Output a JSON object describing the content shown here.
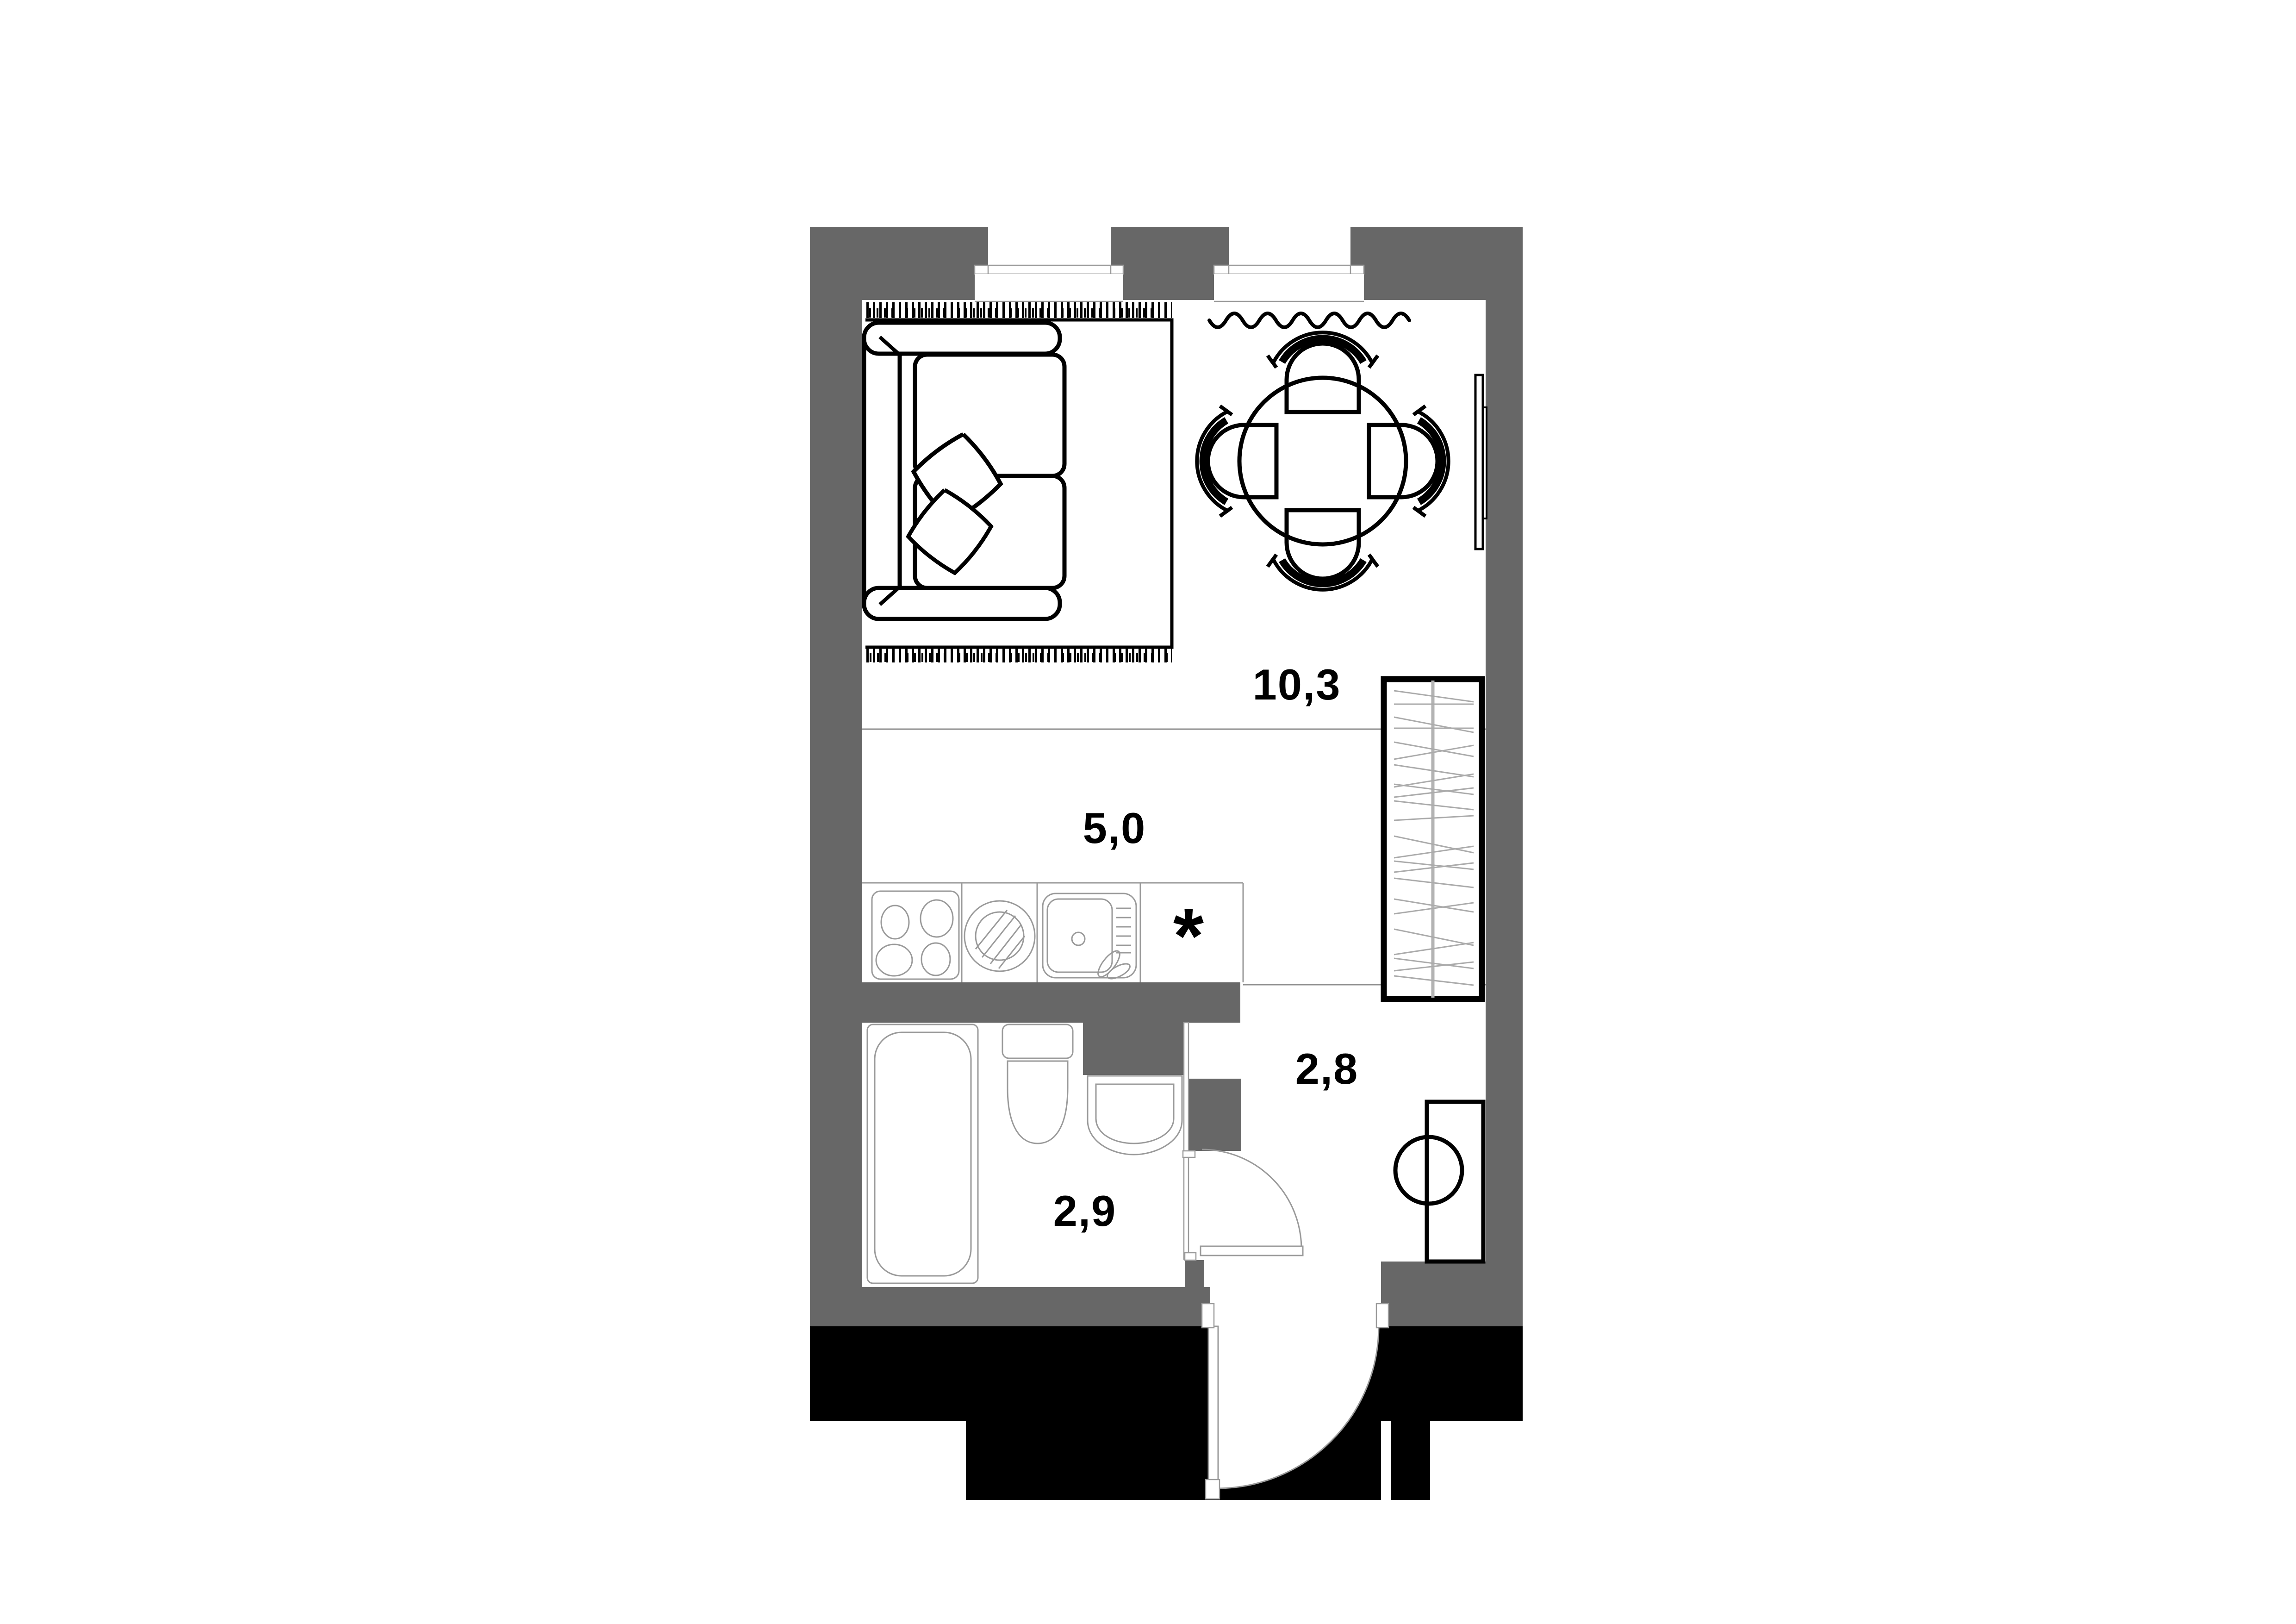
{
  "floor_plan": {
    "type": "studio-apartment-plan",
    "rooms": [
      {
        "name": "living-dining",
        "area_label": "10,3"
      },
      {
        "name": "kitchen",
        "area_label": "5,0"
      },
      {
        "name": "hallway",
        "area_label": "2,8"
      },
      {
        "name": "bathroom",
        "area_label": "2,9"
      }
    ],
    "kitchen_note_marker": "*",
    "colors": {
      "wall_fill": "#676767",
      "footing_fill": "#000000",
      "furniture_line": "#000000",
      "fixture_line": "#9a9a9a",
      "zone_line": "#8f8f8f",
      "floor_fill": "#ffffff",
      "label_color": "#000000"
    }
  }
}
